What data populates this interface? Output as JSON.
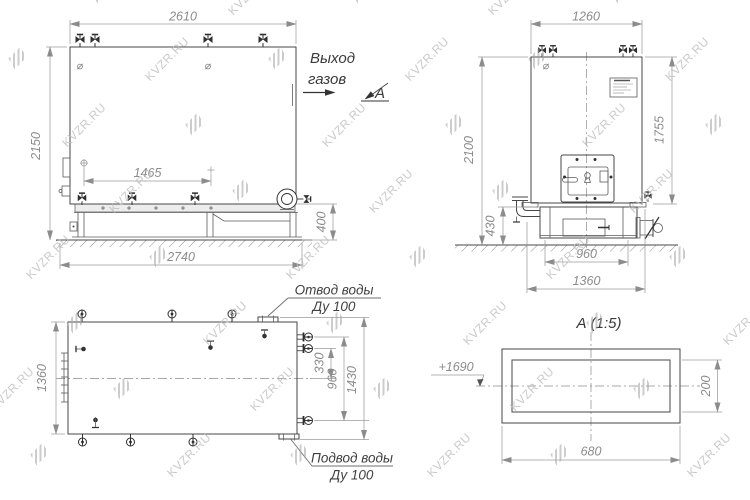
{
  "watermark": {
    "text": "KVZR.RU"
  },
  "front_view": {
    "dim_width_top": "2610",
    "dim_height_left": "2150",
    "dim_inner": "1465",
    "dim_base_width": "2740",
    "dim_base_height": "400",
    "label_gas_out_line1": "Выход",
    "label_gas_out_line2": "газов",
    "section_letter": "А"
  },
  "side_view": {
    "dim_width_top": "1260",
    "dim_height_left": "2100",
    "dim_height_right": "1755",
    "dim_base_height": "430",
    "dim_base_inner": "960",
    "dim_base_width": "1360"
  },
  "plan_view": {
    "dim_depth_left": "1360",
    "dim_nozzle_to_center": "330",
    "dim_nozzle_span": "960",
    "dim_flange_span": "1430",
    "label_outlet_line1": "Отвод воды",
    "label_outlet_line2": "Ду 100",
    "label_inlet_line1": "Подвод воды",
    "label_inlet_line2": "Ду 100"
  },
  "section_view": {
    "title": "А (1:5)",
    "dim_width": "680",
    "dim_height": "200",
    "level_mark": "+1690"
  }
}
